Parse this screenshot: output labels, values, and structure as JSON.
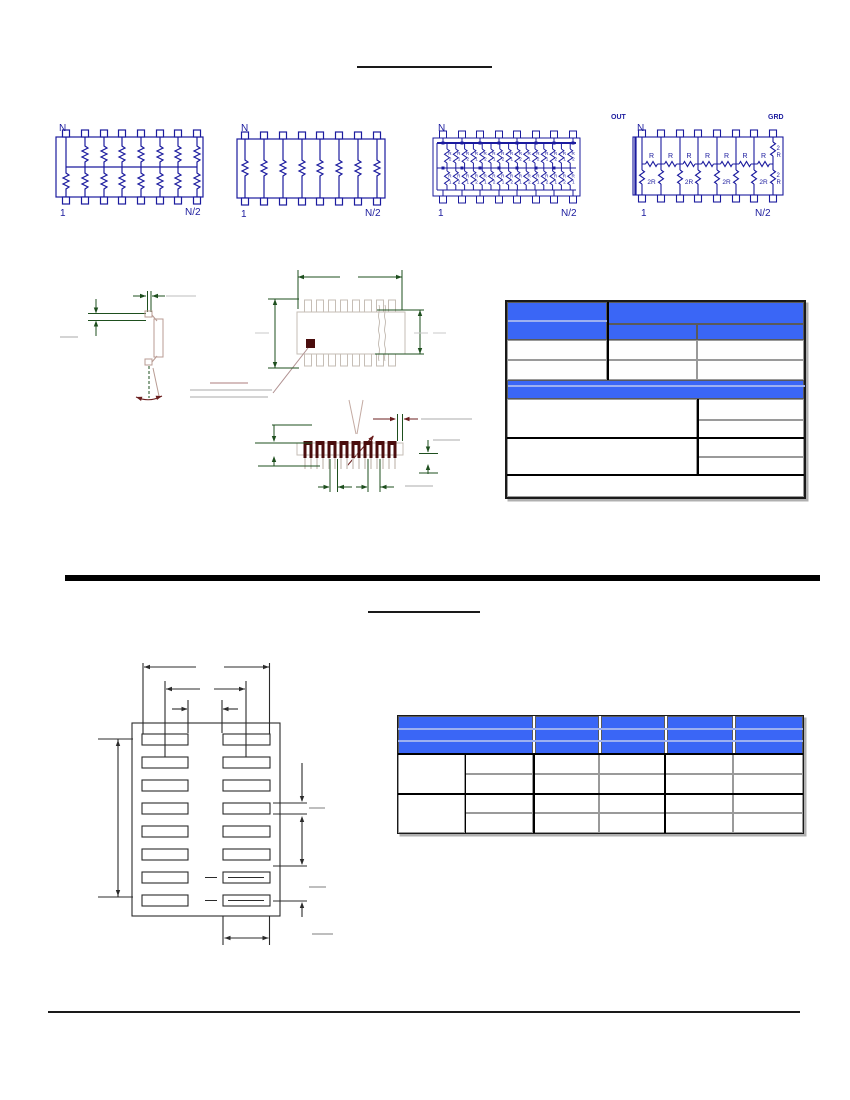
{
  "labels": {
    "s1": {
      "top_left": "N",
      "bottom_left": "1",
      "bottom_right": "N/2"
    },
    "s2": {
      "top_left": "N",
      "bottom_left": "1",
      "bottom_right": "N/2"
    },
    "s3": {
      "top_left": "N",
      "bottom_left": "1",
      "bottom_right": "N/2",
      "r": "R",
      "d1": "1",
      "d2": "2"
    },
    "s4": {
      "out": "OUT",
      "gnd": "GRD",
      "top_left": "N",
      "bottom_left": "1",
      "bottom_right": "N/2",
      "r": "R",
      "r2": "2R",
      "two": "2"
    }
  },
  "colors": {
    "schematic_line": "#1b1b9e",
    "table_header_blue": "#3a66f6",
    "table_hairline_blue": "#9db0f0",
    "dimension_green": "#1e4f1e",
    "dimension_maroon": "#6b1f1f",
    "pin_dark": "#4a0d0d",
    "package_outline": "#c6beb6",
    "leader_gray": "#c9c9c9",
    "drawing_black": "#2b2b2b"
  }
}
